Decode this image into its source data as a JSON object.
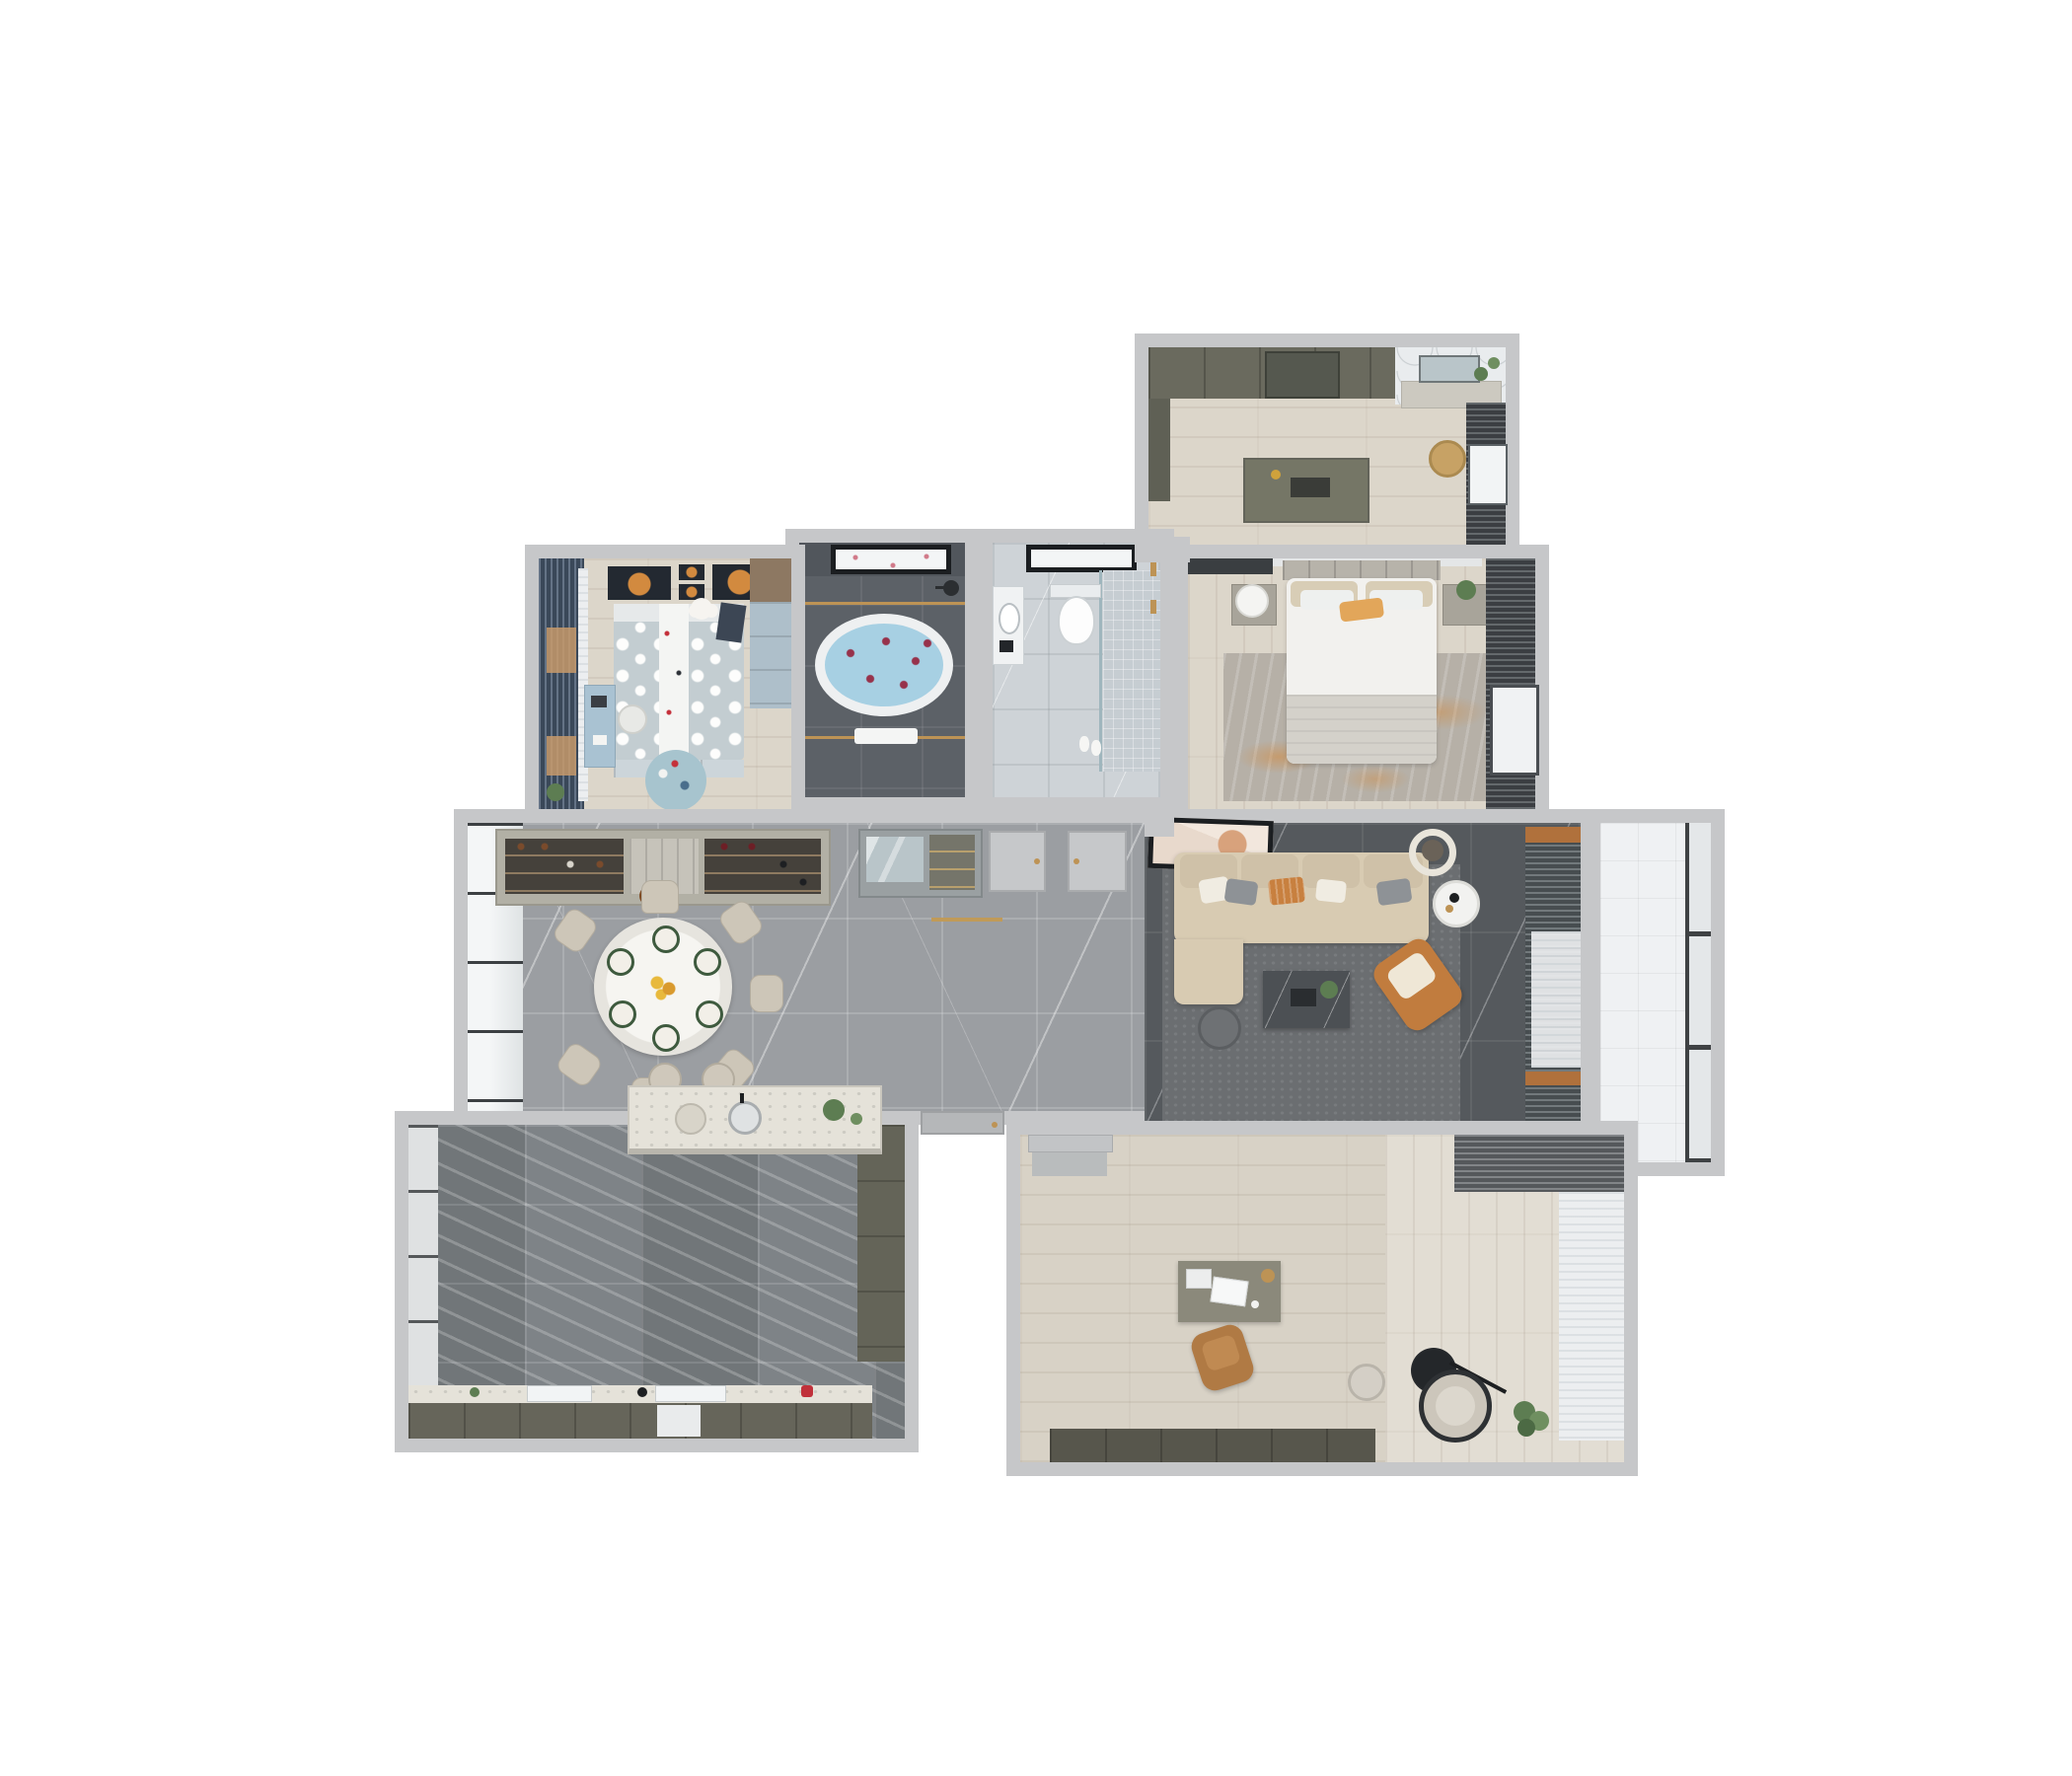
{
  "scene": {
    "kind": "3d-floor-plan-render",
    "view": "top-down dollhouse cutaway of an apartment",
    "background": "#ffffff",
    "visible_text": []
  },
  "colors": {
    "wall": "#c6c7c9",
    "wall_dark": "#aeb0b2",
    "wood_light": "#dcd6ca",
    "hall_floor": "#9b9ea2",
    "kitchen_floor": "#7e8387",
    "bath_floor": "#5c6167",
    "toilet_floor": "#ced3d7",
    "balcony_floor": "#eff1f3",
    "living_floor": "#55595d",
    "study_floor": "#d8d2c6",
    "study_floor_light": "#e2ddd3",
    "rug_living": "#6b6e71",
    "rug_bedroom": "#b6b0a7",
    "rug_kids": "#a7c4ce",
    "sofa": "#d8cbb2",
    "sofa_back": "#cfc1a8",
    "armchair": "#c17c3e",
    "accent_orange": "#d28a3f",
    "curtain_dark": "#4b5054",
    "curtain_blue": "#4a5c72",
    "curtain_study": "#6d7175",
    "sheer": "#eceef0",
    "cabinet_olive": "#6a6a5e",
    "cabinet_olive_dark": "#57564c",
    "cabinet_light": "#b2b0a5",
    "island_top": "#e5e2d9",
    "bed_white": "#f2f1ee",
    "blanket": "#d4d1ca",
    "pillow_beige": "#d8cdb6",
    "kids_duvet": "#c3cdd1",
    "kids_desk": "#a9c2d2",
    "water": "#a7d0e3",
    "petal": "#97324b",
    "gold": "#bd9355",
    "glass": "#f3f5f6",
    "frame_black": "#1b1e21",
    "art_dark": "#232931",
    "table_white": "#efeee9",
    "chair_beige": "#cdc6b8",
    "marble_table": "#4c5054",
    "plant": "#5d7d52",
    "mirror": "#b9c5c9",
    "wood_furniture": "#8d7862",
    "desk_olive": "#8b897b",
    "chair_tan": "#b07a44",
    "red_accent": "#c0303a",
    "duck_yellow": "#e6c23a"
  },
  "rooms": [
    {
      "id": "walk-in-closet",
      "position": "top-right",
      "floor": "light-wood",
      "furniture": [
        "wardrobe-run",
        "glass-wardrobe-section",
        "island-dresser",
        "dressing-table",
        "mirror",
        "plants",
        "rattan-basket",
        "curtain-wall"
      ]
    },
    {
      "id": "master-bedroom",
      "position": "right",
      "floor": "light-wood",
      "furniture": [
        "double-bed",
        "pillows",
        "orange-accent-pillow",
        "headboard",
        "nightstand-left",
        "table-lamp",
        "nightstand-right",
        "plant",
        "area-rug-grey-orange",
        "tv-panel",
        "curtain-wall",
        "roller-blind"
      ]
    },
    {
      "id": "bathroom",
      "position": "top-center",
      "floor": "dark-grey-marble",
      "furniture": [
        "freestanding-bathtub",
        "rose-petals",
        "window",
        "shower-head",
        "towel-rails",
        "towel"
      ]
    },
    {
      "id": "toilet-room",
      "position": "top-center-right",
      "floor": "light-grey-marble",
      "furniture": [
        "wall-hung-toilet",
        "vanity-sink",
        "walk-in-shower",
        "glass-screen",
        "gold-fixtures",
        "window",
        "slippers"
      ]
    },
    {
      "id": "kids-bedroom",
      "position": "top-left",
      "floor": "light-wood",
      "furniture": [
        "single-bed-polka-dot",
        "white-runner-blanket",
        "teddy-bear",
        "wall-art-planets",
        "wardrobe",
        "under-bed-drawers",
        "desk",
        "chair",
        "round-rug",
        "curtains-blue",
        "plant"
      ]
    },
    {
      "id": "dining-hall",
      "position": "center-left",
      "floor": "grey-marble-tile",
      "furniture": [
        "round-dining-table",
        "dining-chairs-x7",
        "place-settings",
        "flower-centerpiece",
        "wine-cabinet",
        "pendant-lamp",
        "entry-console-mirror",
        "interior-door-x2",
        "threshold-strip",
        "bar-stool-x2",
        "window-wall"
      ]
    },
    {
      "id": "living-room",
      "position": "center-right",
      "floor": "dark-marble",
      "furniture": [
        "l-shaped-sofa",
        "back-cushions",
        "throw-pillows",
        "tv-art-frame",
        "coffee-table",
        "plant",
        "round-side-table-white",
        "round-side-table-dark",
        "accent-armchair-orange",
        "area-rug-grey",
        "ceiling-ring-light",
        "curtain-wall",
        "sheer-panel",
        "toy-duck"
      ]
    },
    {
      "id": "balcony",
      "position": "right",
      "floor": "white-tile",
      "furniture": [
        "window-wall-three-pane"
      ]
    },
    {
      "id": "kitchen",
      "position": "bottom-left",
      "floor": "striped-grey-marble",
      "furniture": [
        "island-with-sink",
        "plant",
        "serving-tray",
        "bar-counter-worktop",
        "cooktop",
        "sink-faucet",
        "dishwasher",
        "base-cabinet-run",
        "tall-cabinet-column",
        "window-wall",
        "red-kettle"
      ]
    },
    {
      "id": "study",
      "position": "bottom-right",
      "floor": "light-wood",
      "furniture": [
        "desk",
        "laptop",
        "desk-lamp",
        "books",
        "task-chair-tan",
        "lounge-chair",
        "floor-lamp-black",
        "side-table",
        "potted-plant",
        "low-cabinet-run",
        "curtain-run",
        "sheer-panel",
        "door-mat",
        "interior-door"
      ]
    }
  ],
  "entrance": {
    "id": "main-entry-door",
    "position": "bottom-center-recess"
  }
}
